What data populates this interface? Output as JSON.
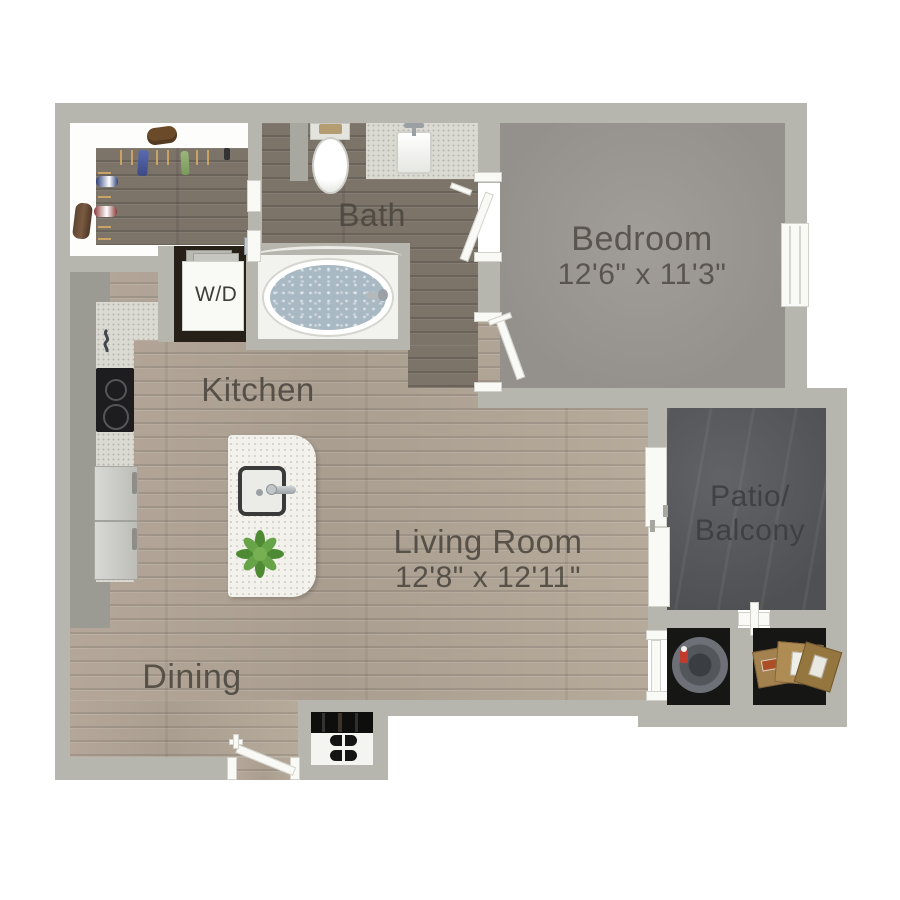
{
  "rooms": {
    "bath": {
      "label": "Bath"
    },
    "laundry": {
      "label": "W/D"
    },
    "bedroom": {
      "label": "Bedroom",
      "dimensions": "12'6\" x 11'3\""
    },
    "kitchen": {
      "label": "Kitchen"
    },
    "living_room": {
      "label": "Living Room",
      "dimensions": "12'8\" x 12'11\""
    },
    "dining": {
      "label": "Dining"
    },
    "patio": {
      "label_line1": "Patio/",
      "label_line2": "Balcony"
    }
  },
  "colors": {
    "wall": "#b6b6ae",
    "wood_light": "#b0a395",
    "wood_dark": "#7c7369",
    "carpet": "#9c9893",
    "concrete": "#55575b",
    "label_text": "#4b463e",
    "water": "#a9b9c4",
    "plant": "#579a3b"
  }
}
